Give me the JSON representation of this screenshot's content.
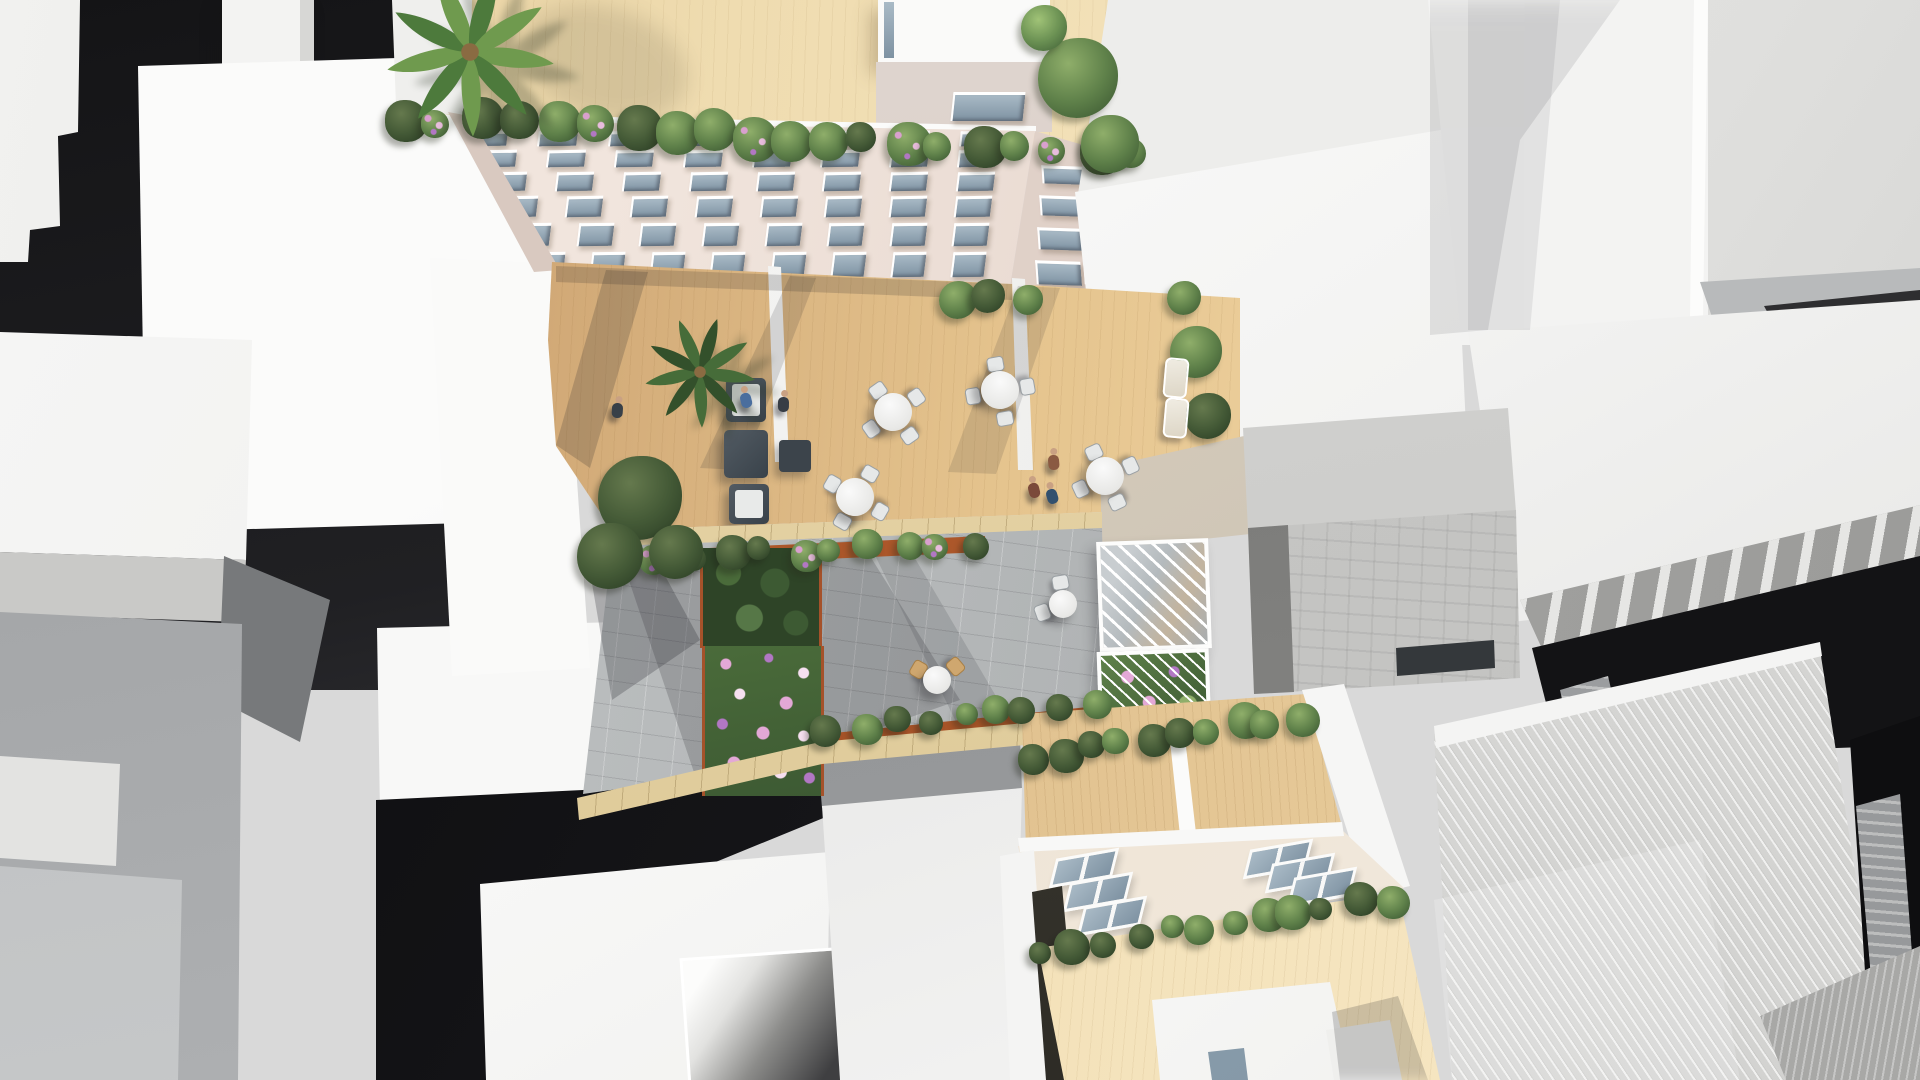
{
  "scene": {
    "title": "Aerial architectural rendering",
    "description": "Bird's-eye 3D architectural rendering of a residential infill block: roof terrace with palm tree, pink-beige facade with recessed windows descending to first-floor timber deck terraces with lounge and dining furniture, a paved courtyard garden with corten planters, flower beds and a slatted pergola, a lower building with roof skylights and deck terraces, all surrounded by abstract white, grey and near-black context massing volumes.",
    "palette": {
      "bg": "#d9d9d9",
      "glass_l": "#a9bac6",
      "glass_d": "#7e92a2",
      "green_hi": "#8fae6a",
      "green_mid": "#5f814a",
      "green_lo": "#3d5a33",
      "skin": "#c9a183",
      "corten": "#b45c2d",
      "stone": "#e8d7ab",
      "deck_sun": "#f3dcab",
      "deck_shade": "#b98f5e",
      "facade": "#eee2da",
      "paver": "#b2b5b6",
      "south_roof": "#eadfd1",
      "canyon": "#131315"
    }
  },
  "objects": {
    "focal_north_building": "apartment block with roof deck, palm tree, penthouse volume, hedge parapet and window facade",
    "courtyard_terraces": "three timber deck terraces divided by white walls, with lounge sofas and round dining tables",
    "garden": "paved courtyard with corten planters, flower bed, bistro tables and slatted pergola",
    "south_building": "lower block with skylight roof, deck terraces, hedges and white penthouse",
    "context": "white, grey and dark untextured massing buildings on all sides"
  },
  "north_facade_windows": {
    "rows": [
      {
        "y": 131,
        "h": 12,
        "x0": 468,
        "x1": 1030,
        "n": 8
      },
      {
        "y": 150,
        "h": 14,
        "x0": 478,
        "x1": 1027,
        "n": 8
      },
      {
        "y": 172,
        "h": 16,
        "x0": 489,
        "x1": 1024,
        "n": 8
      },
      {
        "y": 196,
        "h": 18,
        "x0": 501,
        "x1": 1020,
        "n": 8
      },
      {
        "y": 223,
        "h": 20,
        "x0": 515,
        "x1": 1016,
        "n": 8
      },
      {
        "y": 252,
        "h": 22,
        "x0": 531,
        "x1": 1012,
        "n": 8
      }
    ],
    "width_ratio": 0.52
  },
  "wing_windows": {
    "rows": [
      {
        "y": 166,
        "h": 15,
        "xs": [
          1042,
          1090
        ],
        "w": 40
      },
      {
        "y": 196,
        "h": 17,
        "xs": [
          1040,
          1088
        ],
        "w": 41
      },
      {
        "y": 228,
        "h": 19,
        "xs": [
          1038,
          1086
        ],
        "w": 42
      },
      {
        "y": 261,
        "h": 21,
        "xs": [
          1036,
          1084
        ],
        "w": 43
      }
    ]
  },
  "penthouse_window": {
    "x": 952,
    "y": 92,
    "w": 70,
    "h": 26
  },
  "skylights": {
    "size": {
      "w": 58,
      "h": 22
    },
    "items": [
      [
        1052,
        854
      ],
      [
        1066,
        878
      ],
      [
        1080,
        902
      ],
      [
        1246,
        845
      ],
      [
        1268,
        859
      ],
      [
        1290,
        873
      ]
    ]
  },
  "hedgerows": [
    {
      "x0": 402,
      "y0": 118,
      "x1": 1135,
      "y1": 156,
      "n": 20,
      "rmin": 13,
      "rmax": 23,
      "flowers": true
    },
    {
      "x0": 625,
      "y0": 558,
      "x1": 975,
      "y1": 544,
      "n": 11,
      "rmin": 11,
      "rmax": 18,
      "flowers": true
    },
    {
      "x0": 830,
      "y0": 728,
      "x1": 1092,
      "y1": 705,
      "n": 9,
      "rmin": 10,
      "rmax": 16,
      "flowers": false
    },
    {
      "x0": 1030,
      "y0": 758,
      "x1": 1300,
      "y1": 716,
      "n": 10,
      "rmin": 12,
      "rmax": 19,
      "flowers": false
    },
    {
      "x0": 1042,
      "y0": 950,
      "x1": 1388,
      "y1": 898,
      "n": 12,
      "rmin": 11,
      "rmax": 18,
      "flowers": false
    }
  ],
  "trees": [
    [
      1078,
      78,
      40,
      "m"
    ],
    [
      1110,
      144,
      29,
      "m"
    ],
    [
      1044,
      28,
      23,
      "l"
    ],
    [
      640,
      498,
      42,
      "d"
    ],
    [
      610,
      556,
      33,
      "d"
    ],
    [
      676,
      552,
      27,
      "d"
    ],
    [
      1196,
      352,
      26,
      "m"
    ],
    [
      1208,
      416,
      23,
      "d"
    ],
    [
      1184,
      298,
      17,
      "m"
    ],
    [
      958,
      300,
      19,
      "m"
    ],
    [
      988,
      296,
      17,
      "d"
    ],
    [
      1028,
      300,
      15,
      "m"
    ]
  ],
  "palms": [
    {
      "x": 470,
      "y": 52,
      "r": 88,
      "dark": false
    },
    {
      "x": 700,
      "y": 372,
      "r": 58,
      "dark": true
    }
  ],
  "dining_tables": [
    {
      "x": 893,
      "y": 412,
      "rot": 10
    },
    {
      "x": 1000,
      "y": 390,
      "rot": 35
    },
    {
      "x": 855,
      "y": 497,
      "rot": -15
    },
    {
      "x": 1105,
      "y": 476,
      "rot": 20
    }
  ],
  "bistro_tables": [
    {
      "x": 937,
      "y": 680,
      "type": "rattan",
      "chair_angles": [
        210,
        320
      ]
    },
    {
      "x": 1063,
      "y": 604,
      "type": "white",
      "chair_angles": [
        160,
        260
      ]
    }
  ],
  "loungers": [
    [
      1164,
      358
    ],
    [
      1164,
      398
    ]
  ],
  "people": [
    {
      "x": 740,
      "y": 386,
      "c": "#4a6e9e"
    },
    {
      "x": 778,
      "y": 390,
      "c": "#373d45"
    },
    {
      "x": 612,
      "y": 396,
      "c": "#384048"
    },
    {
      "x": 1028,
      "y": 476,
      "c": "#7b4a3a"
    },
    {
      "x": 1046,
      "y": 482,
      "c": "#32506e"
    },
    {
      "x": 1048,
      "y": 448,
      "c": "#8a5a42"
    }
  ]
}
